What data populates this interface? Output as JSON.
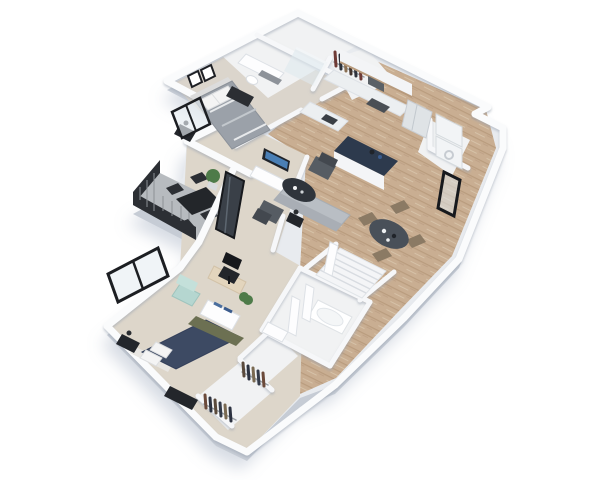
{
  "scene": {
    "label": "3D isometric floor plan render of a two-bedroom, two-bathroom apartment with balcony",
    "view": "isometric-3d",
    "background_color": "#ffffff",
    "shadow_color": "#94a3b8"
  },
  "rooms": [
    {
      "id": "bedroom-1",
      "name": "Bedroom 1",
      "floor": "carpet",
      "furniture": [
        "queen bed with gray striped duvet",
        "black nightstand with lamp",
        "dark dresser bench",
        "two framed wall art pieces",
        "black framed window"
      ]
    },
    {
      "id": "bathroom-1",
      "name": "Bathroom 1",
      "floor": "tile",
      "furniture": [
        "vanity with sink",
        "toilet",
        "glass walk-in shower"
      ]
    },
    {
      "id": "hall-closet",
      "name": "Closet",
      "floor": "tile",
      "furniture": [
        "hanging clothes rod"
      ]
    },
    {
      "id": "kitchen",
      "name": "Kitchen",
      "floor": "wood",
      "furniture": [
        "L-shaped counter with sink",
        "range with hood",
        "upper cabinets",
        "refrigerator",
        "island with navy countertop"
      ]
    },
    {
      "id": "laundry-closet",
      "name": "Laundry / utility closet",
      "floor": "tile",
      "furniture": [
        "washer",
        "dryer",
        "black framed entry door"
      ]
    },
    {
      "id": "living-room",
      "name": "Living room",
      "floor": "wood",
      "furniture": [
        "gray sofa",
        "oval dark coffee table",
        "two dark accent chairs",
        "TV on white media console",
        "black side table with lamp"
      ]
    },
    {
      "id": "dining-nook",
      "name": "Dining nook",
      "floor": "wood",
      "furniture": [
        "round dark dining table",
        "four wood dining chairs"
      ]
    },
    {
      "id": "entry-stairs",
      "name": "Entry stairs",
      "floor": "tile",
      "furniture": [
        "staircase",
        "white interior doors"
      ]
    },
    {
      "id": "den-office",
      "name": "Den / office nook",
      "floor": "carpet",
      "furniture": [
        "desk",
        "black office chair",
        "potted plant"
      ]
    },
    {
      "id": "balcony",
      "name": "Balcony",
      "floor": "concrete",
      "furniture": [
        "black outdoor dining table",
        "four black chairs",
        "potted plant",
        "dark glass balcony door",
        "black metal railing"
      ]
    },
    {
      "id": "bedroom-2",
      "name": "Bedroom 2",
      "floor": "carpet",
      "furniture": [
        "king bed with navy and olive bedding",
        "mint green armchair",
        "white media console with blue decor",
        "black nightstand with lamp",
        "black dresser",
        "large black framed window"
      ]
    },
    {
      "id": "bathroom-2",
      "name": "Bathroom 2",
      "floor": "tile",
      "furniture": [
        "soaking tub",
        "vanity"
      ]
    },
    {
      "id": "walk-in-closet-1",
      "name": "Walk-in closet",
      "floor": "tile",
      "furniture": [
        "hanging clothes rod"
      ]
    },
    {
      "id": "walk-in-closet-2",
      "name": "Walk-in closet",
      "floor": "tile",
      "furniture": [
        "hanging clothes rod"
      ]
    }
  ],
  "palette": {
    "wall_top": "#fafbfc",
    "wall_shade": "#c3c9d2",
    "base_slab": "#e8ebef",
    "slab_side": "#c6ccd5",
    "wood_floor": "#c9ae92",
    "carpet": "#ddd6ca",
    "balcony_floor": "#b7bbbf",
    "railing_black": "#2c2f34",
    "island_top_navy": "#2d3a4d",
    "sofa_gray": "#b9bec4",
    "accent_chair_gray": "#565c63",
    "coffee_table_dark": "#2f343b",
    "dining_table_dark": "#495059",
    "dining_chair_wood": "#8b7a64",
    "bed1_duvet": "#9ba1a9",
    "bed2_duvet_navy": "#3d4a63",
    "bed2_olive": "#6c7052",
    "mint_chair": "#b5d6d0",
    "frame_black": "#1c1e22",
    "plant_green": "#4e7b49",
    "appliance_white": "#f2f4f6"
  }
}
